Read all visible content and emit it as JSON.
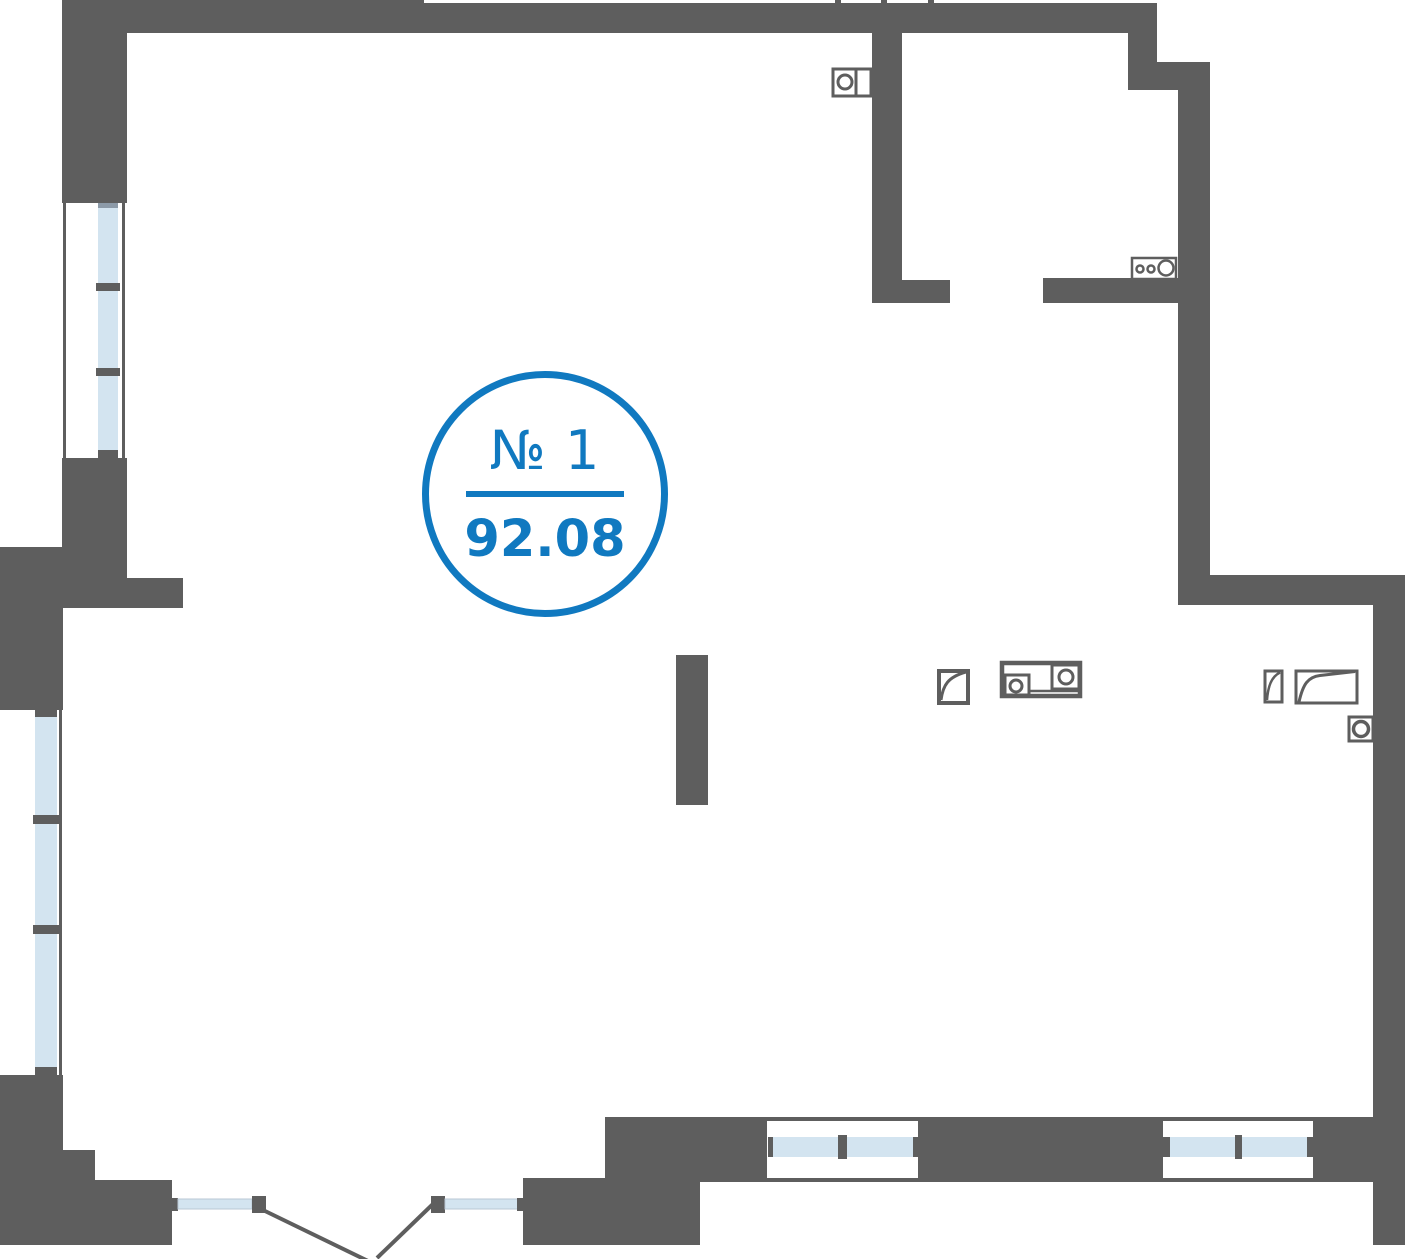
{
  "plan": {
    "title": "apartment-floor-plan",
    "badge": {
      "unit_label": "№ 1",
      "area_value": "92.08"
    },
    "colors": {
      "wall": "#5e5e5e",
      "glass": "#d3e4f0",
      "glassEdge": "#b9c7d4",
      "windowCap": "#8c9aa8",
      "accent": "#1079c0"
    },
    "fixtures": [
      "washing-machine-icon",
      "cooktop-icon",
      "shower-tray-icon",
      "sink-counter-icon",
      "chair-icon",
      "lounge-chair-icon",
      "wall-boiler-icon"
    ],
    "windows": [
      "left-upper-window",
      "left-lower-window",
      "bottom-window-left",
      "bottom-window-right"
    ],
    "doors": [
      "entry-double-door"
    ]
  }
}
